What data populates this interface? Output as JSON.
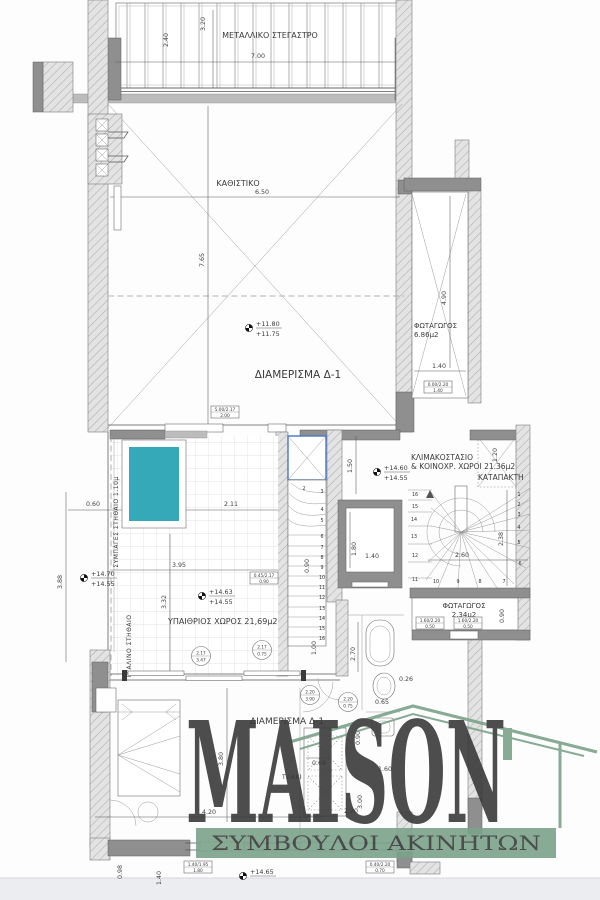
{
  "plan": {
    "labels": {
      "canopy": "ΜΕΤΑΛΛΙΚΟ ΣΤΕΓΑΣΤΡΟ",
      "living": "ΚΑΘΙΣΤΙΚΟ",
      "apartment": "ΔΙΑΜΕΡΙΣΜΑ Δ-1",
      "apartment_red": "ΔΙΑΜΕΡΙΣΜΑ Δ-1",
      "well1_name": "ΦΩΤΑΓΩΓΟΣ",
      "well1_area": "6.86μ2",
      "stair_line1": "ΚΛΙΜΑΚΟΣΤΑΣΙΟ",
      "stair_line2": "& ΚΟΙΝΟΧΡ. ΧΩΡΟΙ 21.36μ2",
      "hatch_door": "ΚΑΤΑΠΑΚΤΗ",
      "terrace": "ΥΠΑΙΘΡΙΟΣ ΧΩΡΟΣ 21,69μ2",
      "well2_name": "ΦΩΤΑΓΩΓΟΣ",
      "well2_area": "2.34μ2",
      "fireplace": "ΤΖΑΚΙ",
      "parapet_solid": "ΣΥΜΠΑΓΕΣ ΣΤΗΘΑΙΟ 1.10μ",
      "parapet_glass": "ΓΥΑΛΙΝΟ ΣΤΗΘΑΙΟ"
    },
    "elevations": {
      "living_a": "+11.80",
      "living_b": "+11.75",
      "stair_a": "+14.60",
      "stair_b": "+14.55",
      "terr1_a": "+14.70",
      "terr1_b": "+14.55",
      "terr2_a": "+14.63",
      "terr2_b": "+14.55",
      "bottom_a": "+14.65"
    },
    "dims": {
      "canopy_w": "7.00",
      "canopy_d1": "2.40",
      "canopy_d2": "3.20",
      "living_w": "6.50",
      "living_h": "7.65",
      "well1_h": "4.90",
      "well1_w": "1.40",
      "stair_off": "1.50",
      "hatch_w": "1.20",
      "shaft_h": "1.80",
      "shaft_w": "1.40",
      "winder_w": "2.60",
      "winder_h": "2.38",
      "lstair_w": "0.90",
      "lstair_h": "1.00",
      "pool_off": "0.60",
      "terr_w1": "2.11",
      "terr_w2": "3.95",
      "terr_h": "3.32",
      "side_h": "3.88",
      "bed_h": "3.80",
      "bed_w": "4.20",
      "low1": "0.98",
      "low2": "1.40",
      "bath_h": "2.70",
      "bath_w": "0.65",
      "bath_t": "0.26",
      "wc_h": "0.90",
      "fire_w": "0.68",
      "hall_w": "2.20",
      "hall_h": "3.00",
      "hall_t": "1.60",
      "well2_h": "0.90"
    },
    "door_tags": [
      {
        "w": "2.17",
        "h": "3.47"
      },
      {
        "w": "2.17",
        "h": "0.75"
      },
      {
        "w": "2.20",
        "h": "3.90"
      },
      {
        "w": "2.20",
        "h": "0.75"
      }
    ],
    "window_tags": [
      {
        "spec": "5.00/2.17",
        "sill": "2.00"
      },
      {
        "spec": "0.00/2.20",
        "sill": "1.40"
      },
      {
        "spec": "0.45/2.17",
        "sill": "0.90"
      },
      {
        "spec": "1.60/2.20",
        "sill": "0.50"
      },
      {
        "spec": "1.60/2.20",
        "sill": "0.50"
      },
      {
        "spec": "1.40/1.95",
        "sill": "1.80"
      },
      {
        "spec": "0.40/2.20",
        "sill": "0.70"
      }
    ],
    "stair_main": [
      "1",
      "2",
      "3",
      "4",
      "5",
      "6",
      "7",
      "8",
      "9",
      "10",
      "11",
      "12",
      "13",
      "14",
      "15",
      "16"
    ],
    "stair_left": [
      "2",
      "3",
      "4",
      "5",
      "6",
      "7",
      "8",
      "9",
      "10",
      "11",
      "12",
      "13",
      "14",
      "15",
      "16"
    ]
  },
  "logo": {
    "name": "MAISON",
    "tagline": "ΣΥΜΒΟΥΛΟΙ ΑΚΙΝΗΤΩΝ"
  },
  "colors": {
    "pool": "#35a9b7",
    "logo_green": "#7ba38a",
    "red_label": "#b2543c",
    "wall_gray": "#8f8f8f"
  }
}
